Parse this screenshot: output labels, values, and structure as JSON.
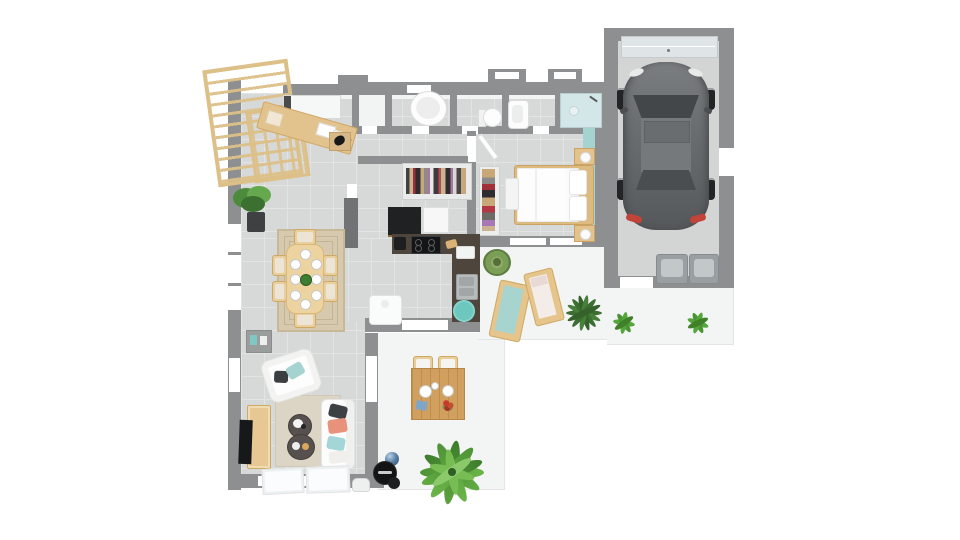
{
  "scene": {
    "type": "3d-floorplan-top-view",
    "style": "photoreal architectural render, single storey house with garage, viewed from directly above"
  },
  "palette": {
    "wall": "#8d8f90",
    "walldark": "#707273",
    "floor": "#d7d9d9",
    "tileline": "#e2e4e4",
    "terrace": "#f3f4f4",
    "teredge": "#e4e6e6",
    "garage": "#d3d5d5",
    "wood": "#e2c28d",
    "wooddark": "#cfa05f",
    "counter": "#4e453d",
    "teal": "#a5d3d0",
    "tealdeep": "#6cc7bf",
    "rugdining": "#d6c9ad",
    "rugliving": "#dcd5c6",
    "green": "#5fa33f",
    "greendark": "#3f6f35",
    "carbody": "#686c6e",
    "cardark": "#4b4f52",
    "carglass": "#43474a",
    "coral": "#e8927c",
    "steel": "#b7bbbc",
    "glass": "#d3e6e8",
    "gdoor": "#dfe4e6",
    "red": "#c24438",
    "black": "#202122"
  },
  "rooms": [
    {
      "id": "entry",
      "objects": [
        "pergola-trellis",
        "console-table",
        "wall-closet",
        "storage-crate-with-cat"
      ]
    },
    {
      "id": "storage-room",
      "objects": []
    },
    {
      "id": "bathroom-1",
      "objects": [
        "oval-bathtub"
      ]
    },
    {
      "id": "wc",
      "objects": [
        "toilet"
      ]
    },
    {
      "id": "bathroom-2",
      "objects": [
        "bathtub"
      ]
    },
    {
      "id": "shower-room",
      "objects": [
        "walk-in-shower"
      ]
    },
    {
      "id": "hallway-dressing",
      "objects": [
        "open-wardrobe-with-clothes",
        "shoe-shelf"
      ]
    },
    {
      "id": "bedroom",
      "objects": [
        "double-bed",
        "foot-bench",
        "nightstand-left",
        "nightstand-right",
        "teal-accent-wall",
        "open-door"
      ]
    },
    {
      "id": "kitchen",
      "objects": [
        "l-shaped-counter",
        "cooktop",
        "double-sink",
        "tall-black-cabinet",
        "white-cabinet",
        "white-appliance",
        "round-teal-rug"
      ]
    },
    {
      "id": "dining-area",
      "objects": [
        "dining-table",
        "six-chairs",
        "eight-place-settings",
        "area-rug",
        "potted-plant",
        "gray-sideboard"
      ]
    },
    {
      "id": "living-room",
      "objects": [
        "sofa",
        "armchair",
        "coffee-table-small",
        "coffee-table-large",
        "tv-cabinet",
        "tv",
        "area-rug",
        "floor-glass-doors"
      ]
    },
    {
      "id": "front-terrace",
      "objects": [
        "outdoor-table",
        "two-outdoor-chairs",
        "palm-plant",
        "barbecue",
        "metal-ball",
        "watering-can"
      ]
    },
    {
      "id": "back-terrace",
      "objects": [
        "sun-lounger-teal",
        "sun-lounger-white",
        "agave-plant",
        "spiky-plant",
        "small-plant",
        "small-plant"
      ]
    },
    {
      "id": "garage",
      "objects": [
        "car-gray-hatchback",
        "sectional-garage-door",
        "two-storage-bins"
      ]
    }
  ]
}
